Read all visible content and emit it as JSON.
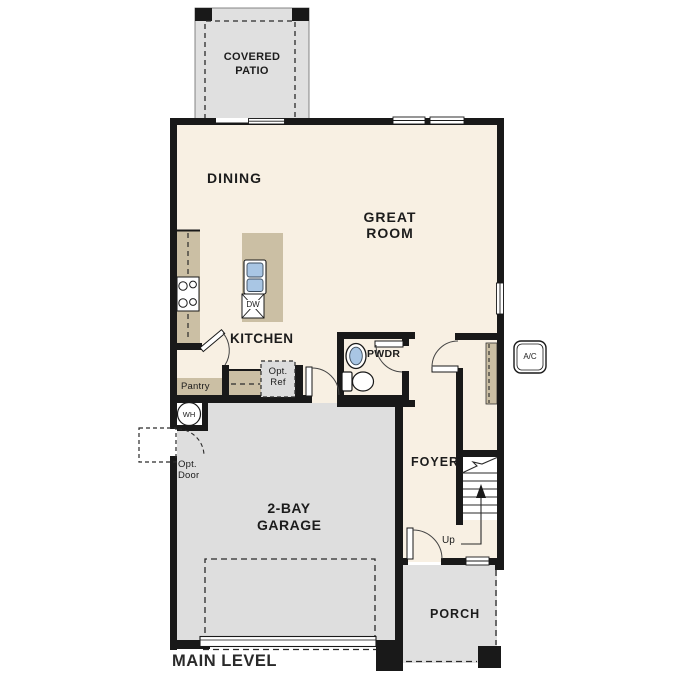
{
  "plan": {
    "title": "MAIN LEVEL",
    "rooms": {
      "covered_patio": "COVERED PATIO",
      "dining": "DINING",
      "great_room": "GREAT ROOM",
      "kitchen": "KITCHEN",
      "pantry": "Pantry",
      "powder_room": "PWDR",
      "foyer": "FOYER",
      "garage": "2-BAY GARAGE",
      "porch": "PORCH"
    },
    "features": {
      "stairs_direction": "Up",
      "water_heater": "WH",
      "dishwasher": "DW",
      "ac_unit": "A/C",
      "optional_refrigerator": "Opt. Ref",
      "optional_door": "Opt. Door"
    },
    "colors": {
      "wall_black": "#191919",
      "floor_cream": "#f8f0e3",
      "concrete_gray": "#e0e0e0",
      "casework_tan": "#cbbfa4",
      "fixture_blue": "#a9c6e4"
    }
  }
}
